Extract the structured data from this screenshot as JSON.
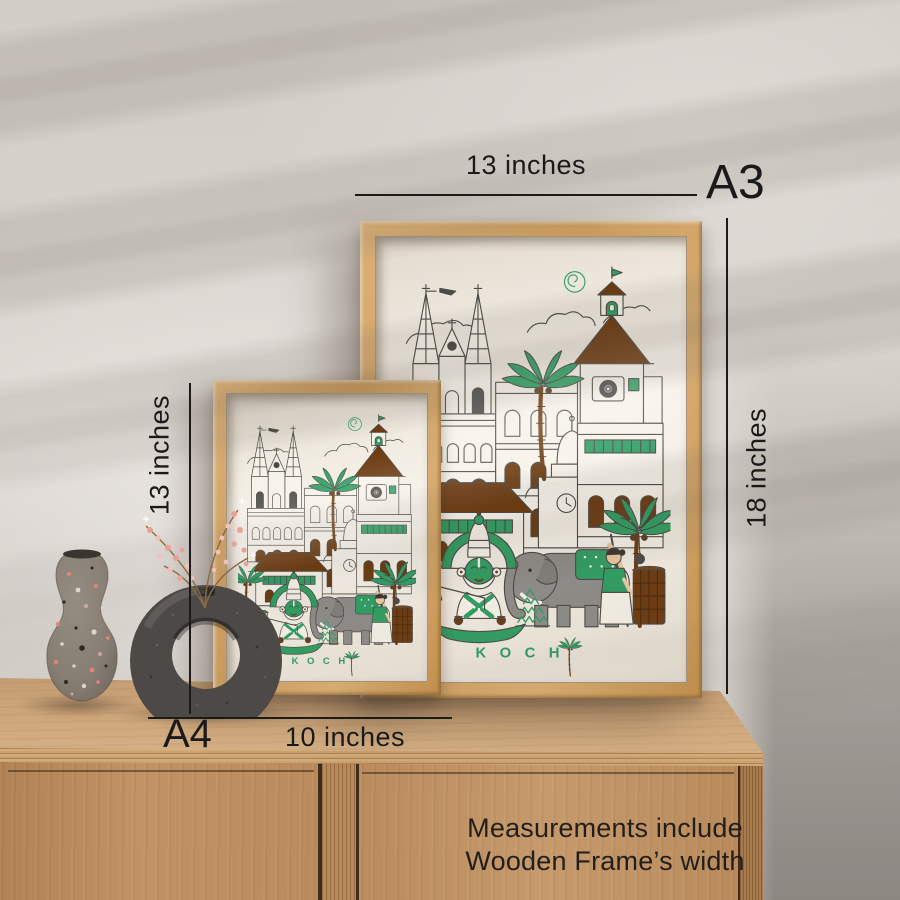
{
  "scene": {
    "poster": {
      "wordmark": "K O C H",
      "wordmark_icon": "palm-tree-letter-i"
    },
    "measurements": {
      "a3_label": "A3",
      "a3_width": "13 inches",
      "a3_height": "18 inches",
      "a4_label": "A4",
      "a4_width": "10 inches",
      "a4_height": "13 inches"
    },
    "note": {
      "line1": "Measurements include",
      "line2": "Wooden Frame’s width"
    },
    "colors": {
      "poster_green": "#2f9e63",
      "poster_brown": "#6b3a10",
      "poster_line": "#4a4a46",
      "elephant_gray": "#8e8c89",
      "frame_wood": "#d2a468",
      "cabinet_wood": "#bd8f60",
      "wall": "#d7d2cc",
      "annotation_ink": "#1b1b1b"
    }
  }
}
